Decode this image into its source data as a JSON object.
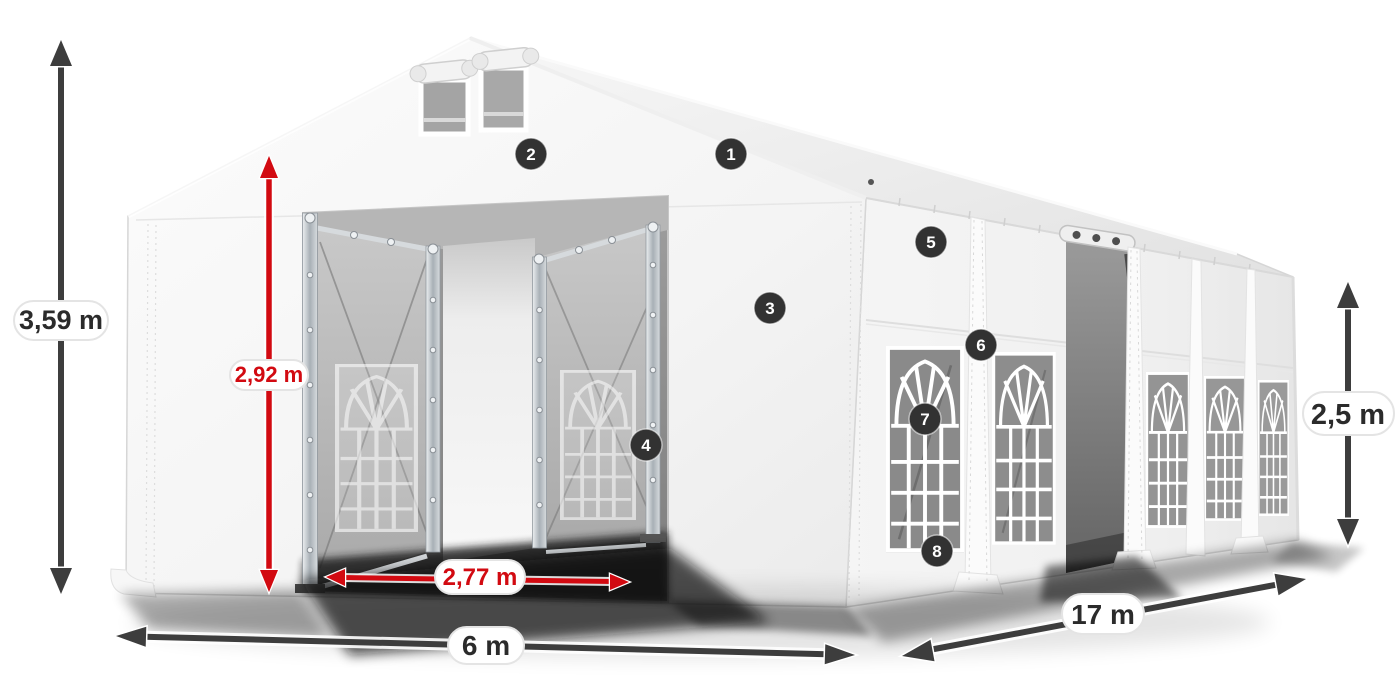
{
  "diagram_title": "Tent dimension diagram",
  "colors": {
    "dimension_red": "#d20a11",
    "dimension_dark": "#3d3d3d",
    "marker_background": "#323232",
    "marker_number": "#ffffff",
    "tent_fabric": "#f5f5f5"
  },
  "dimensions": {
    "total_height": {
      "label": "3,59 m"
    },
    "entrance_height": {
      "label": "2,92 m"
    },
    "entrance_width": {
      "label": "2,77 m"
    },
    "gable_width": {
      "label": "6 m"
    },
    "side_length": {
      "label": "17 m"
    },
    "side_height": {
      "label": "2,5 m"
    }
  },
  "markers": [
    {
      "n": "1"
    },
    {
      "n": "2"
    },
    {
      "n": "3"
    },
    {
      "n": "4"
    },
    {
      "n": "5"
    },
    {
      "n": "6"
    },
    {
      "n": "7"
    },
    {
      "n": "8"
    }
  ]
}
